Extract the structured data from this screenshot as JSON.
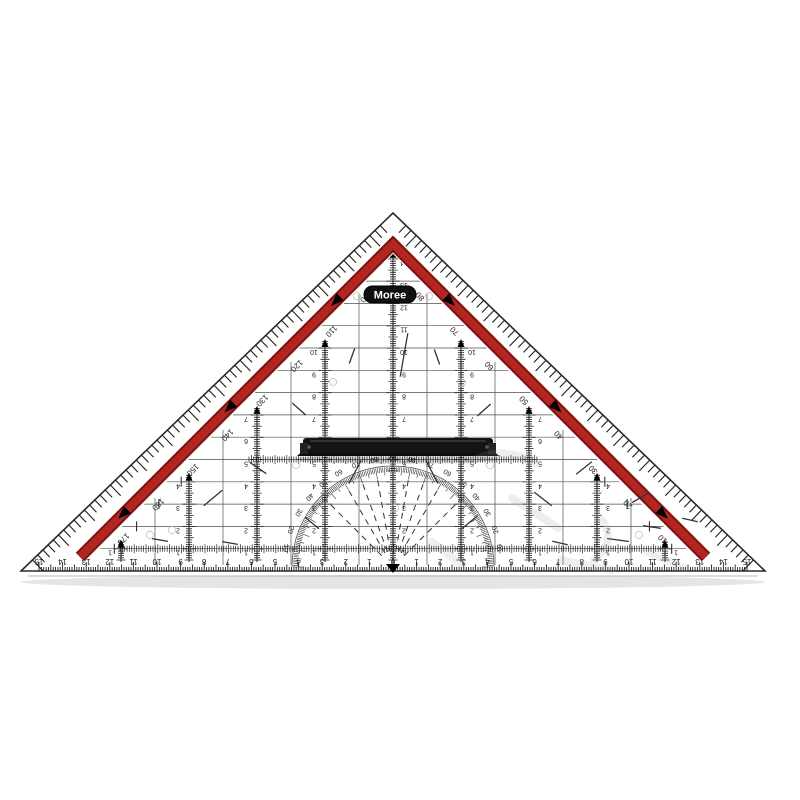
{
  "product": {
    "brand": "Moree",
    "description": "transparent geometry set-square triangle ruler with red protractor band and detachable black handle"
  },
  "colors": {
    "band": "#b22622",
    "band_edge": "#7c1210",
    "ink": "#1e1e1e",
    "grid": "#3c3c3c",
    "handle": "#141414",
    "badge_bg": "#101010",
    "badge_text": "#ffffff",
    "faint": "#bbbbbb",
    "watermark": "#9a9a9a",
    "shadow": "#888888"
  },
  "geometry": {
    "apex": [
      393,
      213
    ],
    "bottom_left": [
      21,
      571
    ],
    "bottom_right": [
      765,
      571
    ],
    "px_per_cm_x": 23.6,
    "px_per_cm_y": 22.3,
    "baseline_y": 571,
    "center_x": 393,
    "band": {
      "apex": [
        393,
        244
      ],
      "left_end": [
        80,
        557
      ],
      "right_end": [
        706,
        557
      ],
      "width": 10,
      "arrow_t": [
        0.18,
        0.52,
        0.86
      ]
    }
  },
  "bottom_ruler": {
    "unit": "cm",
    "zero_label": "0",
    "left_labels": [
      15,
      14,
      13,
      12,
      11,
      10,
      9,
      8,
      7,
      6,
      5,
      4,
      3,
      2,
      1
    ],
    "right_labels": [
      1,
      2,
      3,
      4,
      5,
      6,
      7,
      8,
      9,
      10,
      11,
      12,
      13,
      14,
      15
    ]
  },
  "edge_degree_scale": {
    "left_labels": [
      170,
      160,
      150,
      140,
      130,
      120,
      110,
      100
    ],
    "right_labels": [
      80,
      70,
      60,
      50,
      40,
      30,
      20,
      10
    ]
  },
  "protractor": {
    "radius": 100,
    "labels": [
      {
        "deg": 10,
        "label": "10"
      },
      {
        "deg": 20,
        "label": "20"
      },
      {
        "deg": 30,
        "label": "30"
      },
      {
        "deg": 40,
        "label": "40"
      },
      {
        "deg": 50,
        "label": "50"
      },
      {
        "deg": 60,
        "label": "60"
      },
      {
        "deg": 70,
        "label": "70"
      },
      {
        "deg": 80,
        "label": "80"
      },
      {
        "deg": 90,
        "label": "90"
      },
      {
        "deg": 100,
        "label": "80"
      },
      {
        "deg": 110,
        "label": "70"
      },
      {
        "deg": 120,
        "label": "60"
      },
      {
        "deg": 130,
        "label": "50"
      },
      {
        "deg": 140,
        "label": "40"
      },
      {
        "deg": 150,
        "label": "30"
      },
      {
        "deg": 160,
        "label": "20"
      },
      {
        "deg": 170,
        "label": "10"
      }
    ],
    "fan_angles_deg": [
      45,
      60,
      70,
      80,
      100,
      110,
      120,
      135
    ]
  },
  "columns": {
    "offsets": [
      -272,
      -204,
      -136,
      -68,
      0,
      68,
      136,
      204,
      272
    ],
    "max_cm": [
      1,
      4,
      7,
      10,
      14,
      10,
      7,
      4,
      1
    ]
  },
  "vertical_grid_offsets": [
    -306,
    -238,
    -170,
    -102,
    -34,
    34,
    102,
    170,
    238,
    306
  ],
  "horizontal_rows": 14,
  "ticked_rows": [
    {
      "y_cm": 5,
      "x1": 249,
      "x2": 537
    },
    {
      "y_cm": 1,
      "x1": 120,
      "x2": 666
    }
  ],
  "decor_dashes": [
    [
      213,
      498,
      24,
      40
    ],
    [
      258,
      468,
      20,
      -35
    ],
    [
      312,
      523,
      18,
      -40
    ],
    [
      352,
      356,
      16,
      70
    ],
    [
      437,
      357,
      16,
      -70
    ],
    [
      470,
      522,
      20,
      40
    ],
    [
      543,
      499,
      22,
      -38
    ],
    [
      584,
      468,
      20,
      38
    ],
    [
      618,
      540,
      22,
      -8
    ],
    [
      652,
      527,
      18,
      -8
    ],
    [
      299,
      409,
      18,
      -42
    ],
    [
      484,
      410,
      18,
      42
    ],
    [
      355,
      472,
      26,
      62
    ],
    [
      432,
      472,
      26,
      -62
    ],
    [
      160,
      540,
      16,
      -10
    ],
    [
      230,
      543,
      16,
      -10
    ],
    [
      560,
      543,
      16,
      -12
    ],
    [
      640,
      498,
      18,
      30
    ],
    [
      404,
      355,
      44,
      80
    ],
    [
      690,
      520,
      16,
      -12
    ]
  ],
  "decor_circles": [
    [
      357,
      296
    ],
    [
      429,
      296
    ],
    [
      333,
      382
    ],
    [
      462,
      383
    ],
    [
      150,
      535
    ],
    [
      639,
      535
    ],
    [
      395,
      508
    ],
    [
      296,
      465
    ],
    [
      490,
      465
    ],
    [
      172,
      530
    ]
  ],
  "watermark_strokes": [
    "M470,462 q34,-18 66,2",
    "M512,498 l46,30",
    "M598,516 q22,22 -4,44",
    "M648,552 l36,16",
    "M432,542 l28,22",
    "M560,560 l52,10"
  ]
}
